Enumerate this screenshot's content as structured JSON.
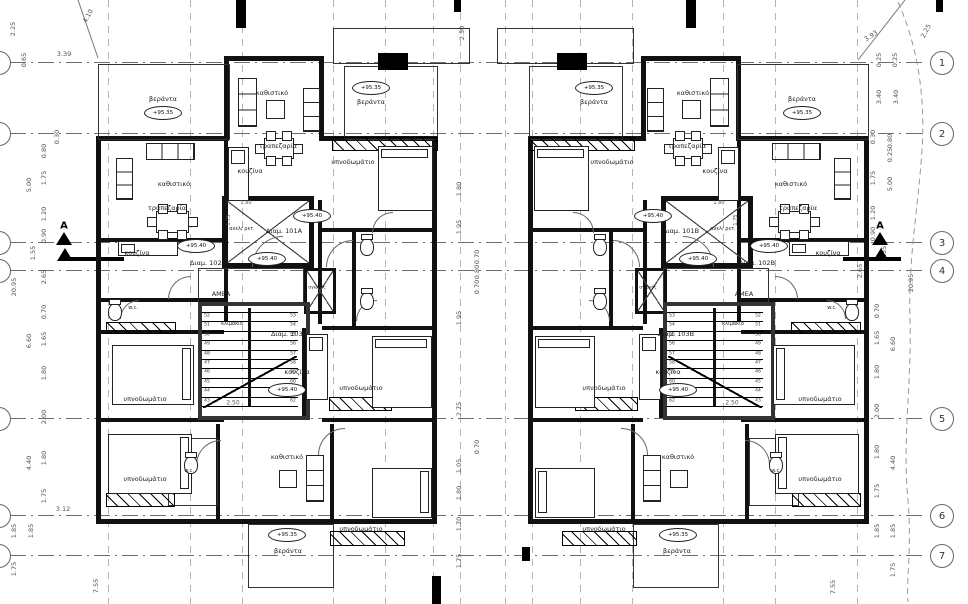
{
  "drawing": {
    "type": "architectural-floor-plan",
    "language": "greek",
    "section_marker_label": "A",
    "stair_width_label": "2.50",
    "elevator_dims": [
      "1.80",
      "1.75"
    ],
    "room_label_names": {
      "veranda": "βεράντα",
      "living": "καθιστικό",
      "dining": "τραπεζαρία",
      "kitchen": "κουζίνα",
      "bedroom": "υπνοδωμάτιο",
      "wc": "w.c.",
      "stair": "κλιμάκιο",
      "elevator": "ανελ/ ρετ.",
      "duct": "αγωγός",
      "amea": "ΑΜΕΑ"
    },
    "elevations": [
      "+95.35",
      "+95.40"
    ],
    "apartments_unit_a": [
      "Διαμ. 101A",
      "Διαμ. 102A",
      "Διαμ. 103A"
    ],
    "apartments_unit_b": [
      "Διαμ. 101B",
      "Διαμ. 102B",
      "Διαμ. 103B"
    ]
  },
  "plan": {
    "mirror_sum": 965,
    "grid": {
      "h_lines_y": [
        62,
        133,
        242,
        270,
        418,
        515,
        555
      ],
      "v_lines_x": [
        108,
        190,
        242,
        333,
        385,
        433,
        460,
        505,
        532,
        580,
        632,
        723,
        775,
        857
      ],
      "bubbles_right": [
        {
          "n": "1",
          "y": 62
        },
        {
          "n": "2",
          "y": 133
        },
        {
          "n": "3",
          "y": 242
        },
        {
          "n": "4",
          "y": 270
        },
        {
          "n": "5",
          "y": 418
        },
        {
          "n": "6",
          "y": 515
        },
        {
          "n": "7",
          "y": 555
        }
      ],
      "bubble_cx_right": 941,
      "bubbles_left_y": [
        62,
        133,
        242,
        270,
        418,
        515,
        555
      ]
    },
    "dims": [
      {
        "t": "2.25",
        "x": 13,
        "y": 29,
        "r": -90
      },
      {
        "t": "0.65",
        "x": 24,
        "y": 60,
        "r": -90
      },
      {
        "t": "3.39",
        "x": 64,
        "y": 54,
        "r": 0
      },
      {
        "t": "4.10",
        "x": 88,
        "y": 16,
        "r": -62
      },
      {
        "t": "0.30",
        "x": 57,
        "y": 137,
        "r": -90
      },
      {
        "t": "0.80",
        "x": 44,
        "y": 151,
        "r": -90
      },
      {
        "t": "1.75",
        "x": 44,
        "y": 178,
        "r": -90
      },
      {
        "t": "5.00",
        "x": 29,
        "y": 185,
        "r": -90
      },
      {
        "t": "1.20",
        "x": 44,
        "y": 214,
        "r": -90
      },
      {
        "t": "0.90",
        "x": 44,
        "y": 236,
        "r": -90
      },
      {
        "t": "1.55",
        "x": 33,
        "y": 253,
        "r": -90
      },
      {
        "t": "2.65",
        "x": 44,
        "y": 277,
        "r": -90
      },
      {
        "t": "20.95",
        "x": 14,
        "y": 287,
        "r": -90
      },
      {
        "t": "0.70",
        "x": 44,
        "y": 312,
        "r": -90
      },
      {
        "t": "1.65",
        "x": 44,
        "y": 339,
        "r": -90
      },
      {
        "t": "6.60",
        "x": 29,
        "y": 341,
        "r": -90
      },
      {
        "t": "1.80",
        "x": 44,
        "y": 373,
        "r": -90
      },
      {
        "t": "2.00",
        "x": 44,
        "y": 417,
        "r": -90
      },
      {
        "t": "1.80",
        "x": 44,
        "y": 458,
        "r": -90
      },
      {
        "t": "4.40",
        "x": 29,
        "y": 463,
        "r": -90
      },
      {
        "t": "1.75",
        "x": 44,
        "y": 496,
        "r": -90
      },
      {
        "t": "3.12",
        "x": 63,
        "y": 509,
        "r": 0
      },
      {
        "t": "1.85",
        "x": 14,
        "y": 531,
        "r": -90
      },
      {
        "t": "1.85",
        "x": 31,
        "y": 531,
        "r": -90
      },
      {
        "t": "1.75",
        "x": 14,
        "y": 569,
        "r": -90
      },
      {
        "t": "7.55",
        "x": 96,
        "y": 586,
        "r": -90
      },
      {
        "t": "2.25",
        "x": 926,
        "y": 31,
        "r": -62
      },
      {
        "t": "3.93",
        "x": 871,
        "y": 36,
        "r": -33
      },
      {
        "t": "0.25",
        "x": 879,
        "y": 60,
        "r": -90
      },
      {
        "t": "0.25",
        "x": 895,
        "y": 60,
        "r": -90
      },
      {
        "t": "3.40",
        "x": 879,
        "y": 97,
        "r": -90
      },
      {
        "t": "3.40",
        "x": 896,
        "y": 97,
        "r": -90
      },
      {
        "t": "0.30",
        "x": 873,
        "y": 137,
        "r": -90
      },
      {
        "t": "0.80",
        "x": 890,
        "y": 141,
        "r": -90
      },
      {
        "t": "0.25",
        "x": 890,
        "y": 155,
        "r": -90
      },
      {
        "t": "1.75",
        "x": 873,
        "y": 178,
        "r": -90
      },
      {
        "t": "5.00",
        "x": 890,
        "y": 184,
        "r": -90
      },
      {
        "t": "1.20",
        "x": 873,
        "y": 213,
        "r": -90
      },
      {
        "t": "0.90",
        "x": 873,
        "y": 234,
        "r": -90
      },
      {
        "t": "1.55",
        "x": 884,
        "y": 253,
        "r": -90
      },
      {
        "t": "2.65",
        "x": 860,
        "y": 271,
        "r": -90
      },
      {
        "t": "20.95",
        "x": 911,
        "y": 283,
        "r": -90
      },
      {
        "t": "0.70",
        "x": 877,
        "y": 311,
        "r": -90
      },
      {
        "t": "1.65",
        "x": 877,
        "y": 338,
        "r": -90
      },
      {
        "t": "6.60",
        "x": 893,
        "y": 344,
        "r": -90
      },
      {
        "t": "1.80",
        "x": 877,
        "y": 372,
        "r": -90
      },
      {
        "t": "2.00",
        "x": 877,
        "y": 411,
        "r": -90
      },
      {
        "t": "1.80",
        "x": 877,
        "y": 452,
        "r": -90
      },
      {
        "t": "4.40",
        "x": 893,
        "y": 463,
        "r": -90
      },
      {
        "t": "1.75",
        "x": 877,
        "y": 491,
        "r": -90
      },
      {
        "t": "1.85",
        "x": 877,
        "y": 531,
        "r": -90
      },
      {
        "t": "1.85",
        "x": 893,
        "y": 531,
        "r": -90
      },
      {
        "t": "1.75",
        "x": 893,
        "y": 570,
        "r": -90
      },
      {
        "t": "7.55",
        "x": 833,
        "y": 587,
        "r": -90
      },
      {
        "t": "2.50",
        "x": 462,
        "y": 33,
        "r": -90
      },
      {
        "t": "1.80",
        "x": 459,
        "y": 189,
        "r": -90
      },
      {
        "t": "1.95",
        "x": 459,
        "y": 227,
        "r": -90
      },
      {
        "t": "0.70",
        "x": 477,
        "y": 257,
        "r": -90
      },
      {
        "t": "0.80",
        "x": 477,
        "y": 272,
        "r": -90
      },
      {
        "t": "0.70",
        "x": 477,
        "y": 287,
        "r": -90
      },
      {
        "t": "1.95",
        "x": 459,
        "y": 318,
        "r": -90
      },
      {
        "t": "2.75",
        "x": 459,
        "y": 409,
        "r": -90
      },
      {
        "t": "0.70",
        "x": 477,
        "y": 447,
        "r": -90
      },
      {
        "t": "1.05",
        "x": 459,
        "y": 466,
        "r": -90
      },
      {
        "t": "1.80",
        "x": 459,
        "y": 493,
        "r": -90
      },
      {
        "t": "1.70",
        "x": 459,
        "y": 524,
        "r": -90
      },
      {
        "t": "1.75",
        "x": 459,
        "y": 561,
        "r": -90
      }
    ],
    "unit": {
      "walls": [
        [
          96,
          136,
          133,
          5
        ],
        [
          322,
          136,
          115,
          5
        ],
        [
          224,
          56,
          100,
          5
        ],
        [
          224,
          58,
          5,
          83
        ],
        [
          319,
          58,
          5,
          83
        ],
        [
          96,
          136,
          5,
          388
        ],
        [
          432,
          136,
          5,
          388
        ],
        [
          96,
          519,
          341,
          5
        ],
        [
          224,
          141,
          4,
          180
        ],
        [
          318,
          200,
          4,
          124
        ],
        [
          96,
          238,
          128,
          4
        ],
        [
          96,
          298,
          128,
          4
        ],
        [
          96,
          330,
          128,
          4
        ],
        [
          96,
          418,
          128,
          4
        ],
        [
          322,
          228,
          110,
          4
        ],
        [
          352,
          228,
          4,
          100
        ],
        [
          322,
          326,
          110,
          4
        ],
        [
          322,
          418,
          110,
          4
        ],
        [
          216,
          424,
          4,
          95
        ],
        [
          330,
          424,
          4,
          95
        ],
        [
          302,
          328,
          4,
          90
        ]
      ],
      "thin_outlines": [
        [
          98,
          64,
          130,
          74
        ],
        [
          344,
          66,
          92,
          72
        ],
        [
          333,
          28,
          135,
          34
        ],
        [
          248,
          524,
          84,
          62
        ],
        [
          168,
          438,
          48,
          66
        ]
      ],
      "piers": [
        [
          378,
          53,
          30,
          17
        ]
      ],
      "hatches": [
        [
          332,
          137,
          104,
          12
        ],
        [
          106,
          322,
          68,
          10
        ],
        [
          329,
          397,
          61,
          12
        ],
        [
          106,
          493,
          67,
          12
        ],
        [
          330,
          531,
          73,
          13
        ]
      ],
      "shafts": [
        {
          "x": 222,
          "y": 196,
          "w": 82,
          "h": 62,
          "b": 5
        },
        {
          "x": 304,
          "y": 268,
          "w": 26,
          "h": 40,
          "b": 3
        },
        {
          "x": 198,
          "y": 268,
          "w": 104,
          "h": 34,
          "b": 2,
          "noX": true
        }
      ],
      "stair": {
        "x": 198,
        "y": 302,
        "w": 104,
        "h": 110,
        "b": 4,
        "nums_left": [
          "52",
          "51",
          "50",
          "49",
          "48",
          "47",
          "46",
          "45",
          "44",
          "43"
        ],
        "nums_right": [
          "53",
          "54",
          "55",
          "56",
          "57",
          "58",
          "59",
          "60",
          "61",
          "62"
        ]
      },
      "arcs": [
        {
          "x": 252,
          "y": 236,
          "r": 30
        },
        {
          "x": 168,
          "y": 276,
          "r": 22
        },
        {
          "x": 326,
          "y": 240,
          "r": 26
        },
        {
          "x": 196,
          "y": 440,
          "r": 24
        },
        {
          "x": 318,
          "y": 428,
          "r": 26
        },
        {
          "x": 120,
          "y": 300,
          "r": 18
        },
        {
          "x": 356,
          "y": 300,
          "r": 20
        },
        {
          "x": 372,
          "y": 212,
          "r": 20
        }
      ],
      "furniture": [
        {
          "k": "sofa",
          "x": 238,
          "y": 78,
          "w": 17,
          "h": 47
        },
        {
          "k": "sofa",
          "x": 303,
          "y": 88,
          "w": 15,
          "h": 42
        },
        {
          "k": "tv",
          "x": 266,
          "y": 100,
          "w": 17,
          "h": 17
        },
        {
          "k": "table",
          "x": 258,
          "y": 133,
          "w": 40,
          "h": 29
        },
        {
          "k": "counter",
          "x": 228,
          "y": 147,
          "w": 19,
          "h": 52
        },
        {
          "k": "sofa",
          "x": 146,
          "y": 143,
          "w": 47,
          "h": 15
        },
        {
          "k": "sofa",
          "x": 116,
          "y": 158,
          "w": 15,
          "h": 40
        },
        {
          "k": "table",
          "x": 150,
          "y": 206,
          "w": 43,
          "h": 30
        },
        {
          "k": "counter",
          "x": 118,
          "y": 241,
          "w": 58,
          "h": 13
        },
        {
          "k": "bed",
          "x": 378,
          "y": 146,
          "w": 53,
          "h": 63
        },
        {
          "k": "wc",
          "x": 360,
          "y": 238,
          "w": 12,
          "h": 16
        },
        {
          "k": "wc",
          "x": 360,
          "y": 292,
          "w": 12,
          "h": 16
        },
        {
          "k": "bed",
          "x": 112,
          "y": 345,
          "w": 80,
          "h": 58
        },
        {
          "k": "wc",
          "x": 108,
          "y": 303,
          "w": 12,
          "h": 16
        },
        {
          "k": "bed",
          "x": 372,
          "y": 336,
          "w": 58,
          "h": 70
        },
        {
          "k": "counter",
          "x": 306,
          "y": 334,
          "w": 20,
          "h": 64
        },
        {
          "k": "bed",
          "x": 108,
          "y": 434,
          "w": 82,
          "h": 58
        },
        {
          "k": "wc",
          "x": 184,
          "y": 456,
          "w": 12,
          "h": 16
        },
        {
          "k": "sofa",
          "x": 306,
          "y": 455,
          "w": 16,
          "h": 45
        },
        {
          "k": "tv",
          "x": 279,
          "y": 470,
          "w": 16,
          "h": 16
        },
        {
          "k": "bed",
          "x": 372,
          "y": 468,
          "w": 58,
          "h": 48
        }
      ],
      "labels": [
        {
          "t": "βεράντα",
          "x": 163,
          "y": 99
        },
        {
          "oval": "+95.35",
          "x": 163,
          "y": 113
        },
        {
          "t": "καθιστικό",
          "x": 272,
          "y": 93
        },
        {
          "t": "τραπεζαρία",
          "x": 278,
          "y": 146
        },
        {
          "t": "κουζίνα",
          "x": 250,
          "y": 171
        },
        {
          "oval": "+95.35",
          "x": 371,
          "y": 88
        },
        {
          "t": "βεράντα",
          "x": 371,
          "y": 102
        },
        {
          "t": "καθιστικό",
          "x": 174,
          "y": 184
        },
        {
          "t": "τραπεζαρία",
          "x": 167,
          "y": 208
        },
        {
          "oval": "+95.40",
          "x": 196,
          "y": 246
        },
        {
          "t": "κουζίνα",
          "x": 137,
          "y": 253
        },
        {
          "apt": 1,
          "x": 208,
          "y": 263
        },
        {
          "t": "υπνοδωμάτιο",
          "x": 353,
          "y": 162
        },
        {
          "t": "ανελ/ ρετ.",
          "x": 242,
          "y": 229,
          "s": 5
        },
        {
          "apt": 0,
          "x": 284,
          "y": 231
        },
        {
          "oval": "+95.40",
          "x": 312,
          "y": 216
        },
        {
          "oval": "+95.40",
          "x": 267,
          "y": 259
        },
        {
          "t": "ΑΜΕΑ",
          "x": 221,
          "y": 294
        },
        {
          "t": "αγωγός",
          "x": 317,
          "y": 288,
          "s": 4.5
        },
        {
          "t": "w.c.",
          "x": 133,
          "y": 308,
          "s": 5
        },
        {
          "t": "κλιμάκιο",
          "x": 232,
          "y": 324,
          "s": 5
        },
        {
          "apt": 2,
          "x": 289,
          "y": 334
        },
        {
          "t": "υπνοδωμάτιο",
          "x": 145,
          "y": 399
        },
        {
          "t": "κουζίνα",
          "x": 297,
          "y": 372
        },
        {
          "oval": "+95.40",
          "x": 287,
          "y": 390
        },
        {
          "t": "υπνοδωμάτιο",
          "x": 361,
          "y": 388
        },
        {
          "t": "2.50",
          "x": 233,
          "y": 403,
          "s": 6,
          "dim": true
        },
        {
          "t": "1.80",
          "x": 246,
          "y": 203,
          "s": 5,
          "dim": true
        },
        {
          "t": "1.75",
          "x": 229,
          "y": 220,
          "s": 5,
          "dim": true,
          "r": -90
        },
        {
          "t": "υπνοδωμάτιο",
          "x": 145,
          "y": 479
        },
        {
          "t": "w.c.",
          "x": 189,
          "y": 471,
          "s": 5
        },
        {
          "t": "καθιστικό",
          "x": 287,
          "y": 457
        },
        {
          "oval": "+95.35",
          "x": 287,
          "y": 535
        },
        {
          "t": "βεράντα",
          "x": 288,
          "y": 551
        },
        {
          "t": "υπνοδωμάτιο",
          "x": 361,
          "y": 529
        }
      ]
    },
    "global_piers": [
      [
        236,
        0,
        10,
        28
      ],
      [
        686,
        0,
        10,
        28
      ],
      [
        454,
        0,
        7,
        12
      ],
      [
        936,
        0,
        7,
        12
      ],
      [
        432,
        576,
        9,
        28
      ],
      [
        522,
        547,
        8,
        14
      ]
    ],
    "sections": [
      {
        "x": 56,
        "y": 228,
        "line_x": 66,
        "line_w": 58,
        "dir": 1
      },
      {
        "x": 872,
        "y": 228,
        "line_x": 843,
        "line_w": 58,
        "dir": -1
      }
    ],
    "property_line": "M 898,2 C 915,40 926,90 922,150 C 918,210 908,260 910,320 C 912,380 902,440 908,500 C 912,550 906,580 908,602"
  }
}
